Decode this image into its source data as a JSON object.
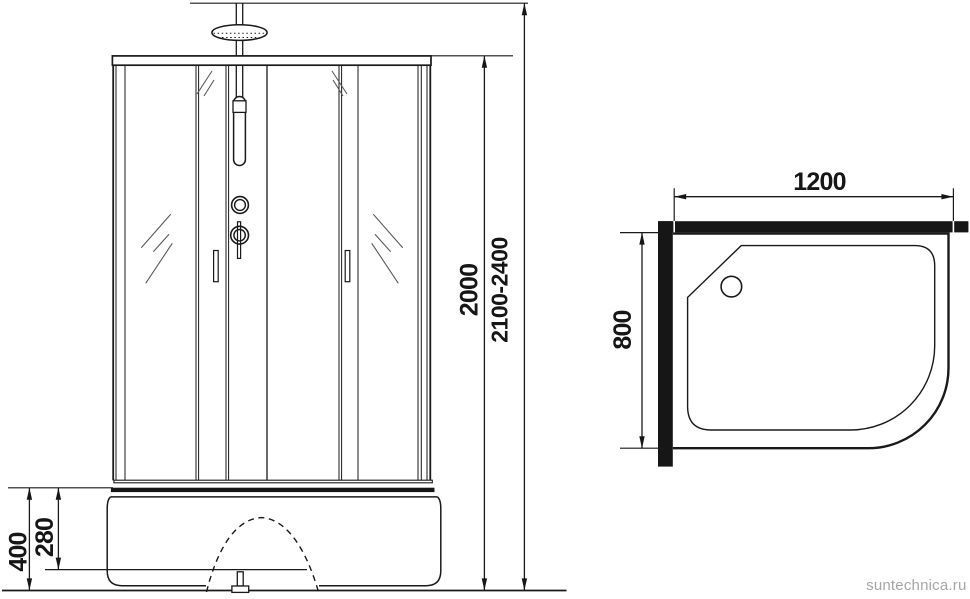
{
  "front_view": {
    "dimensions": {
      "glass_height": "2000",
      "total_height": "2100-2400",
      "base_total_height": "400",
      "base_upper_height": "280"
    }
  },
  "top_view": {
    "dimensions": {
      "width": "1200",
      "depth": "800"
    }
  },
  "watermark": {
    "text": "suntechnica.ru",
    "color": "#a6a6a6"
  },
  "colors": {
    "line": "#1a1a1a",
    "solid_fill": "#161616",
    "hatch": "#5a5a5a",
    "background": "#ffffff"
  }
}
